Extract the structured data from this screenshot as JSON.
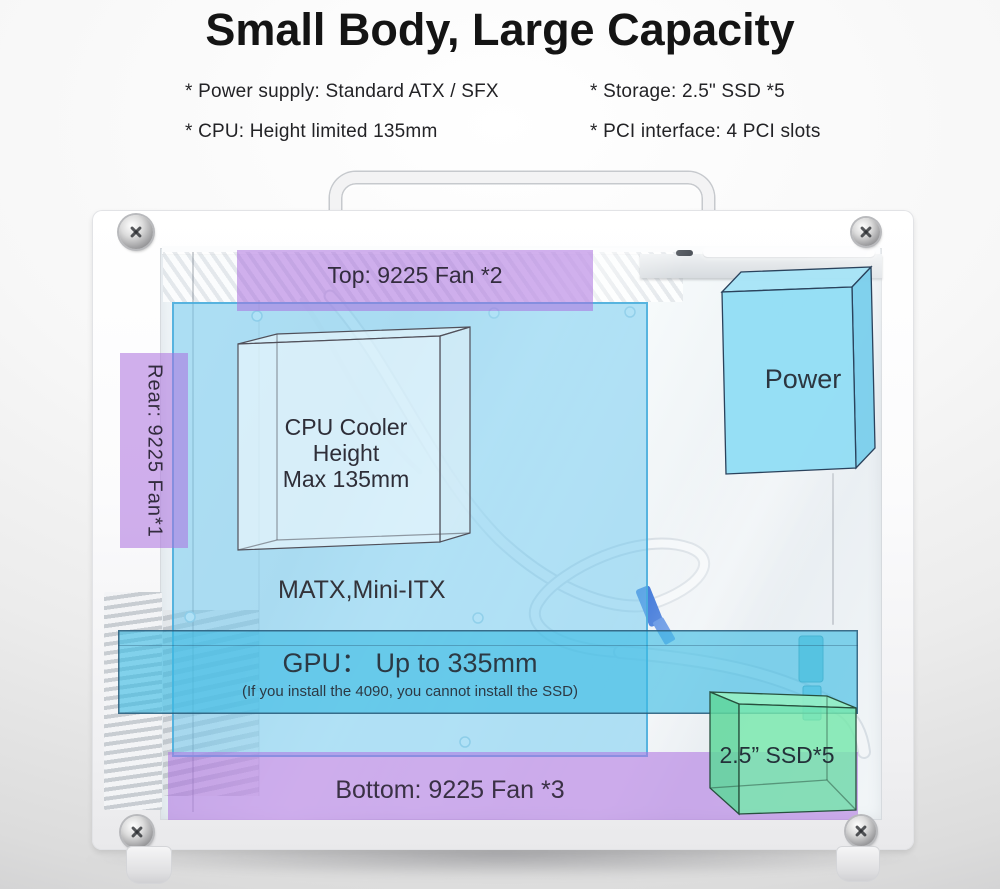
{
  "title": "Small Body, Large Capacity",
  "specs": [
    {
      "label": "* Power supply: Standard ATX / SFX"
    },
    {
      "label": "* Storage: 2.5\" SSD *5"
    },
    {
      "label": "* CPU: Height limited 135mm"
    },
    {
      "label": "* PCI interface: 4 PCI slots"
    }
  ],
  "diagram": {
    "top_fan_label": "Top: 9225 Fan *2",
    "rear_fan_label": "Rear: 9225 Fan*1",
    "cpu_cooler_lines": [
      "CPU Cooler",
      "Height",
      "Max 135mm"
    ],
    "motherboard_label": "MATX,Mini-ITX",
    "power_label": "Power",
    "gpu_label": "GPU： Up to 335mm",
    "gpu_note": "(If you install the 4090, you cannot install the SSD)",
    "ssd_label": "2.5” SSD*5",
    "bottom_fan_label": "Bottom: 9225 Fan *3",
    "colors": {
      "fan_zone_purple": "#c9a0e8",
      "motherboard_zone_blue": "#a8dcf2",
      "gpu_zone_cyan": "#5ec9e8",
      "power_box_blue": "#8edcf4",
      "ssd_box_green": "#7ee9b3",
      "label_text": "#2e2e38"
    }
  }
}
